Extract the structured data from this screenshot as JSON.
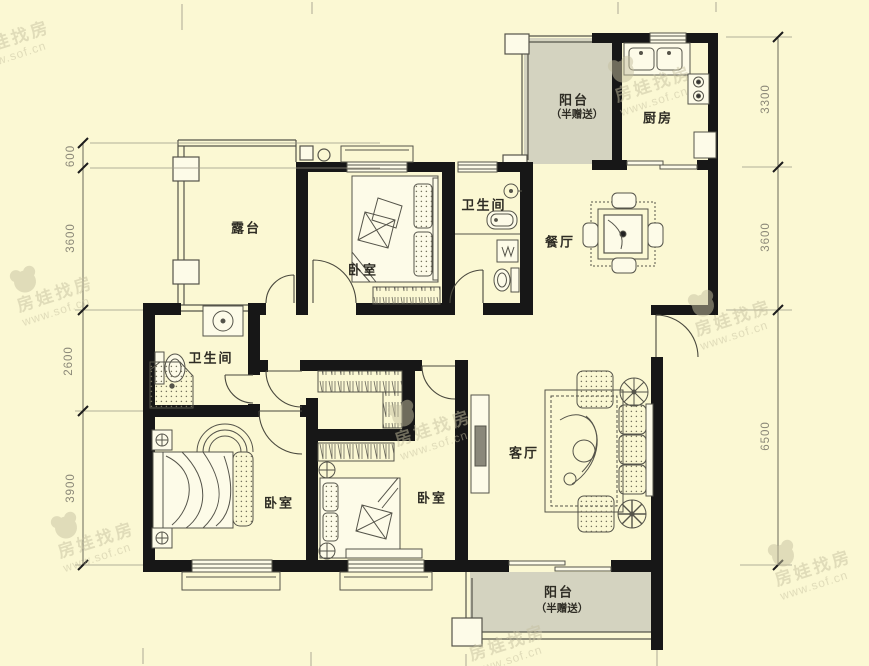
{
  "page": {
    "type": "residential-floor-plan"
  },
  "watermark": {
    "brand": "房娃找房",
    "url": "www.sof.cn"
  },
  "rooms": {
    "terrace": {
      "label": "露台"
    },
    "bedroom_top": {
      "label": "卧室"
    },
    "bathroom_top": {
      "label": "卫生间"
    },
    "balcony_top": {
      "label": "阳台",
      "sublabel": "（半赠送）"
    },
    "kitchen": {
      "label": "厨房"
    },
    "dining": {
      "label": "餐厅"
    },
    "bathroom_mid": {
      "label": "卫生间"
    },
    "bedroom_left": {
      "label": "卧室"
    },
    "bedroom_mid": {
      "label": "卧室"
    },
    "living": {
      "label": "客厅"
    },
    "balcony_bottom": {
      "label": "阳台",
      "sublabel": "（半赠送）"
    }
  },
  "dimensions": {
    "left": [
      {
        "value": "600"
      },
      {
        "value": "3600"
      },
      {
        "value": "2600"
      },
      {
        "value": "3900"
      }
    ],
    "right": [
      {
        "value": "3300"
      },
      {
        "value": "3600"
      },
      {
        "value": "6500"
      }
    ]
  },
  "colors": {
    "background": "#fbf8d3",
    "balcony_fill": "#d4d3c0",
    "wall": "#171717",
    "line": "#55544a",
    "dimension_text": "#8b8878",
    "label_text": "#2e2c24",
    "watermark": "#c6c1a1"
  }
}
